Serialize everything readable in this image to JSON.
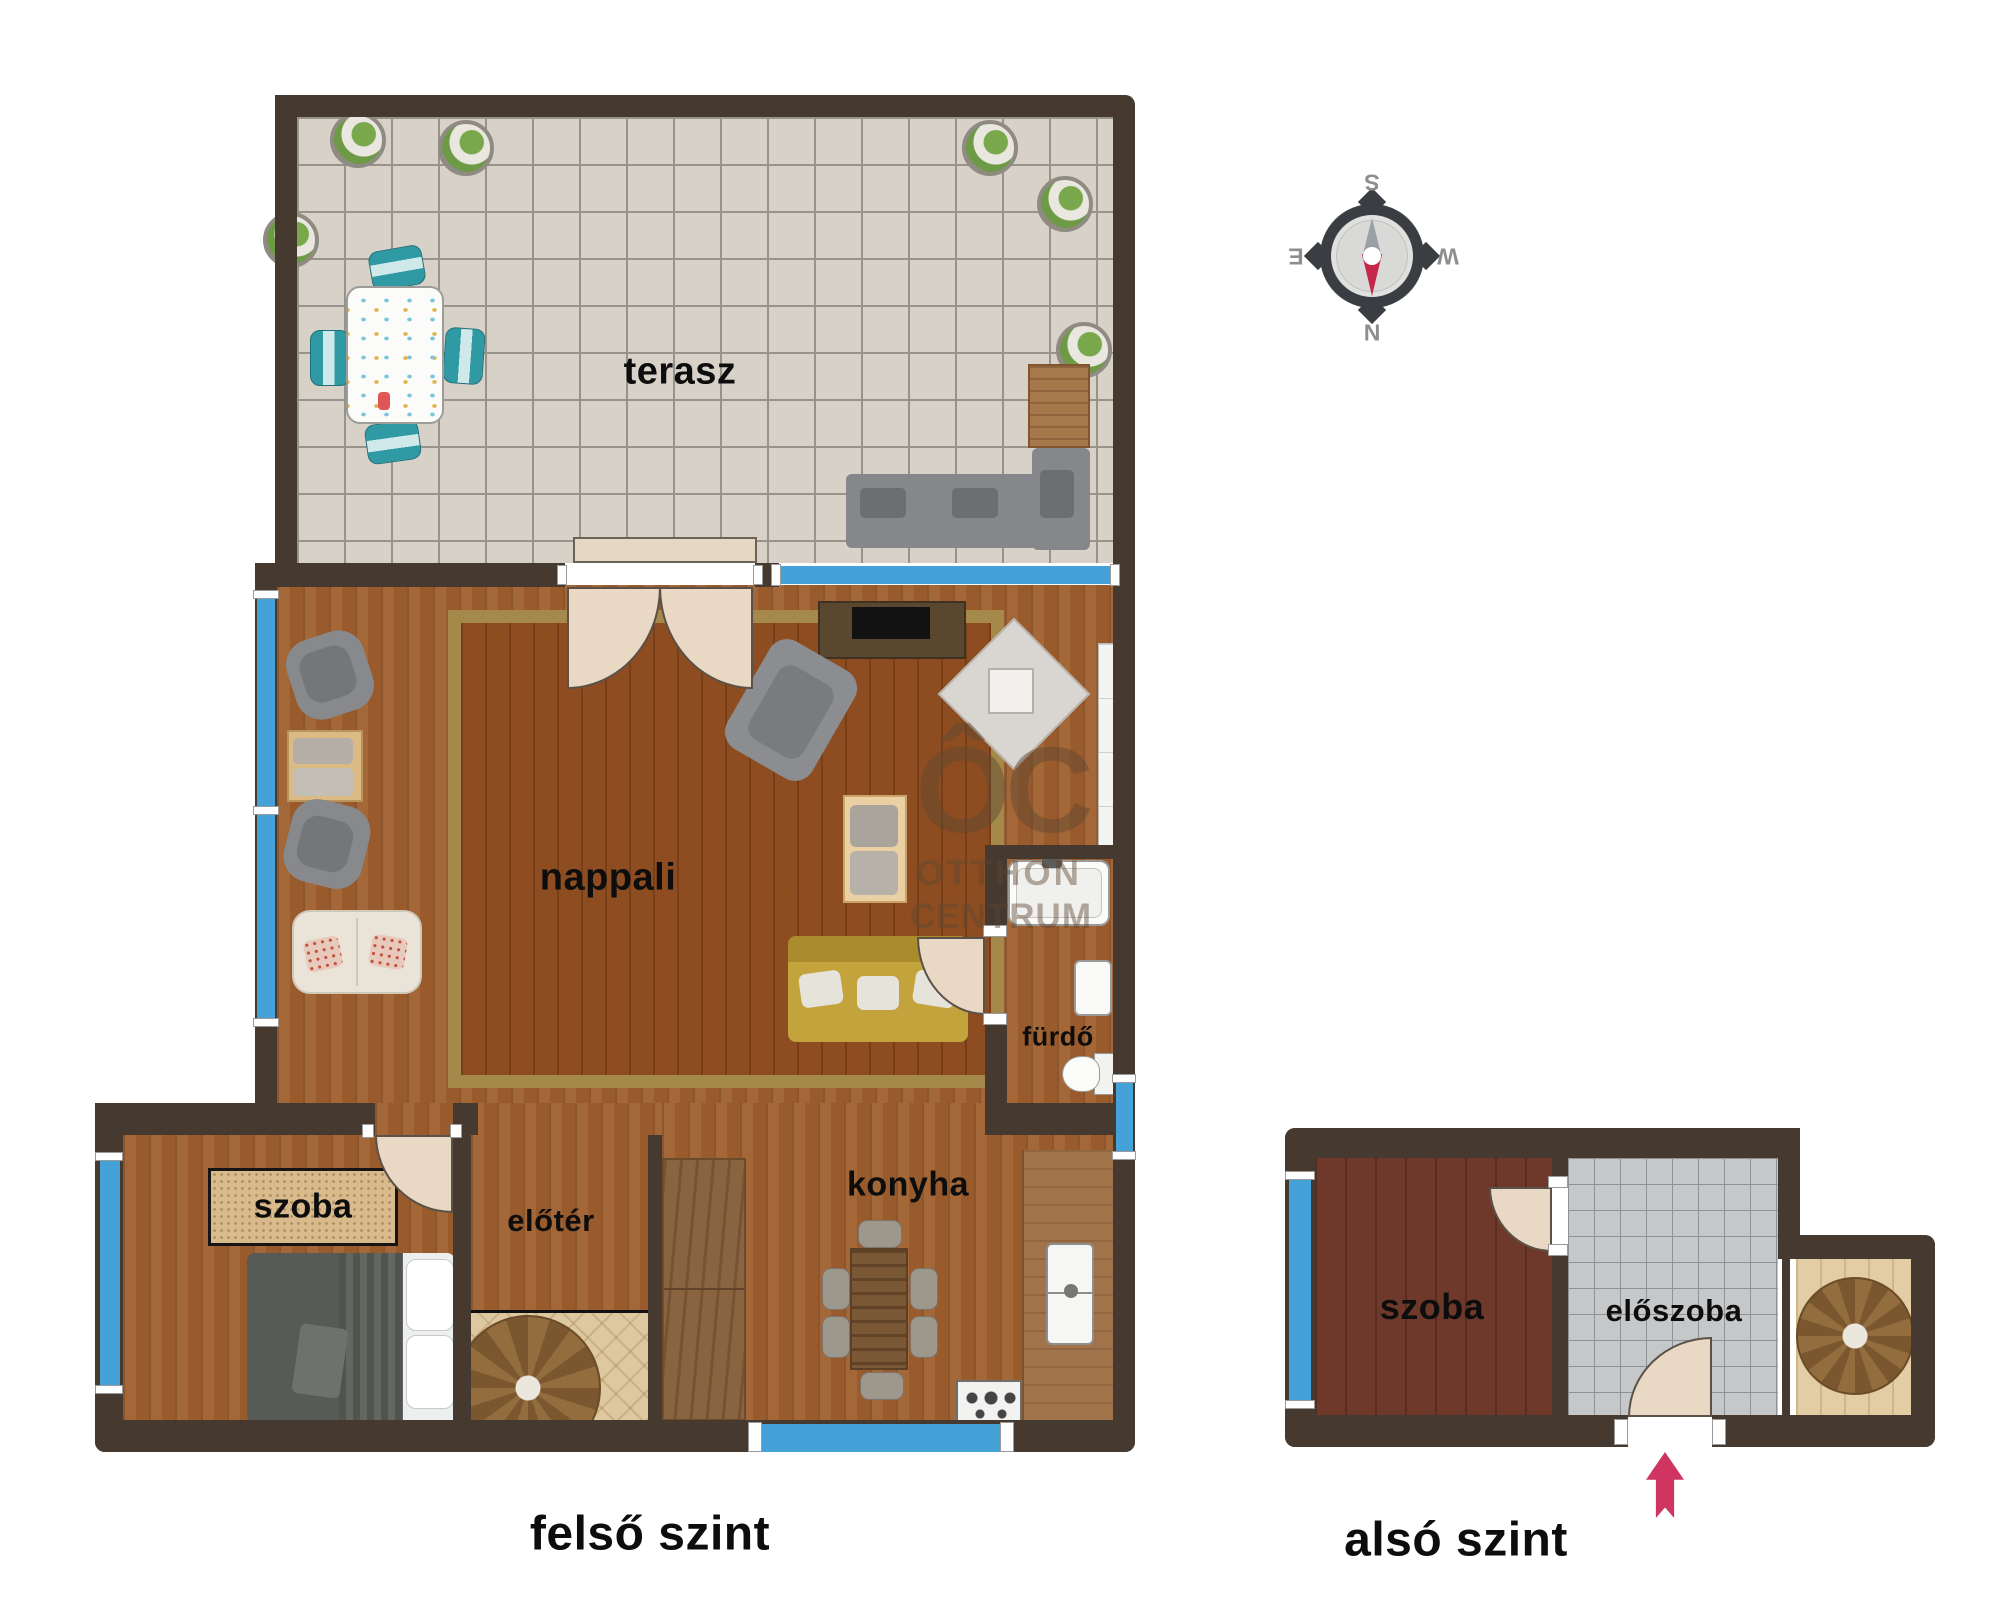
{
  "upper_plan": {
    "title": "felső szint",
    "rooms": {
      "terrace": "terasz",
      "living_room": "nappali",
      "bathroom": "fürdő",
      "bedroom": "szoba",
      "hall": "előtér",
      "kitchen": "konyha"
    }
  },
  "lower_plan": {
    "title": "alsó szint",
    "rooms": {
      "room": "szoba",
      "entrance_hall": "előszoba"
    }
  },
  "compass": {
    "north": "N",
    "south": "S",
    "east": "E",
    "west": "W"
  },
  "watermark": {
    "logo": "ÔC",
    "line1": "OTTHON",
    "line2": "CENTRUM"
  },
  "colors": {
    "wall": "#46392f",
    "window_blue": "#45a2d9",
    "entry_arrow": "#cf3560",
    "compass_needle_red": "#c5274a",
    "terrace_tile": "#d8d1c8",
    "living_wood": "#995a2c",
    "lower_room_wood": "#6e392a",
    "hall_tile_gray": "#c5c7c9",
    "door_leaf": "#e9d9c4",
    "sofa_yellow": "#c2a33c"
  }
}
